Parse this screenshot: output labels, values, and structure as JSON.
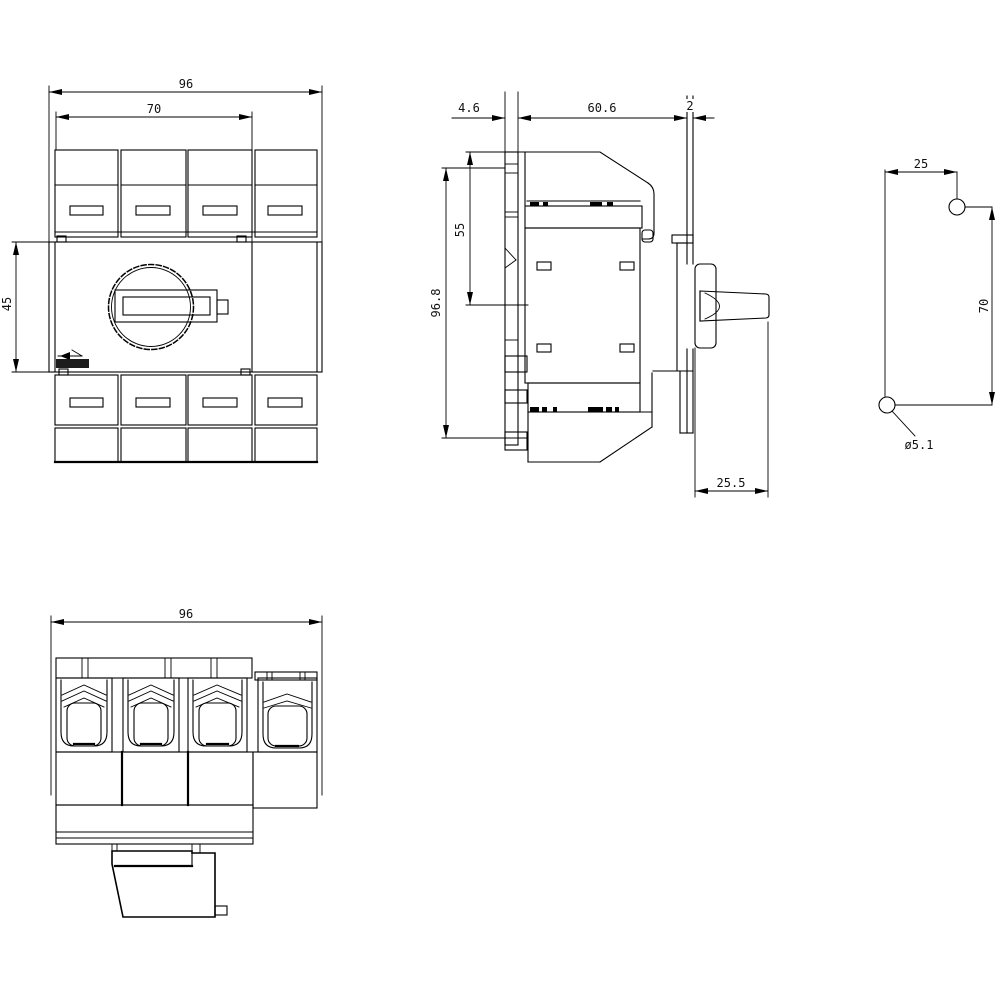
{
  "drawing": {
    "background": "#ffffff",
    "line_color": "#000000",
    "views": {
      "front": {
        "dim_overall_width": "96",
        "dim_pole_section_width": "70",
        "dim_handle_axis_height": "45"
      },
      "side": {
        "dim_rail_depth": "4.6",
        "dim_body_depth": "60.6",
        "dim_panel_thickness": "2",
        "dim_top_to_handle_axis": "55",
        "dim_overall_height": "96.8",
        "dim_handle_projection": "25.5"
      },
      "drill_plan": {
        "dim_hole_offset_horizontal": "25",
        "dim_hole_spacing_vertical": "70",
        "dim_hole_diameter": "ø5.1"
      },
      "bottom": {
        "dim_overall_width": "96"
      }
    }
  }
}
